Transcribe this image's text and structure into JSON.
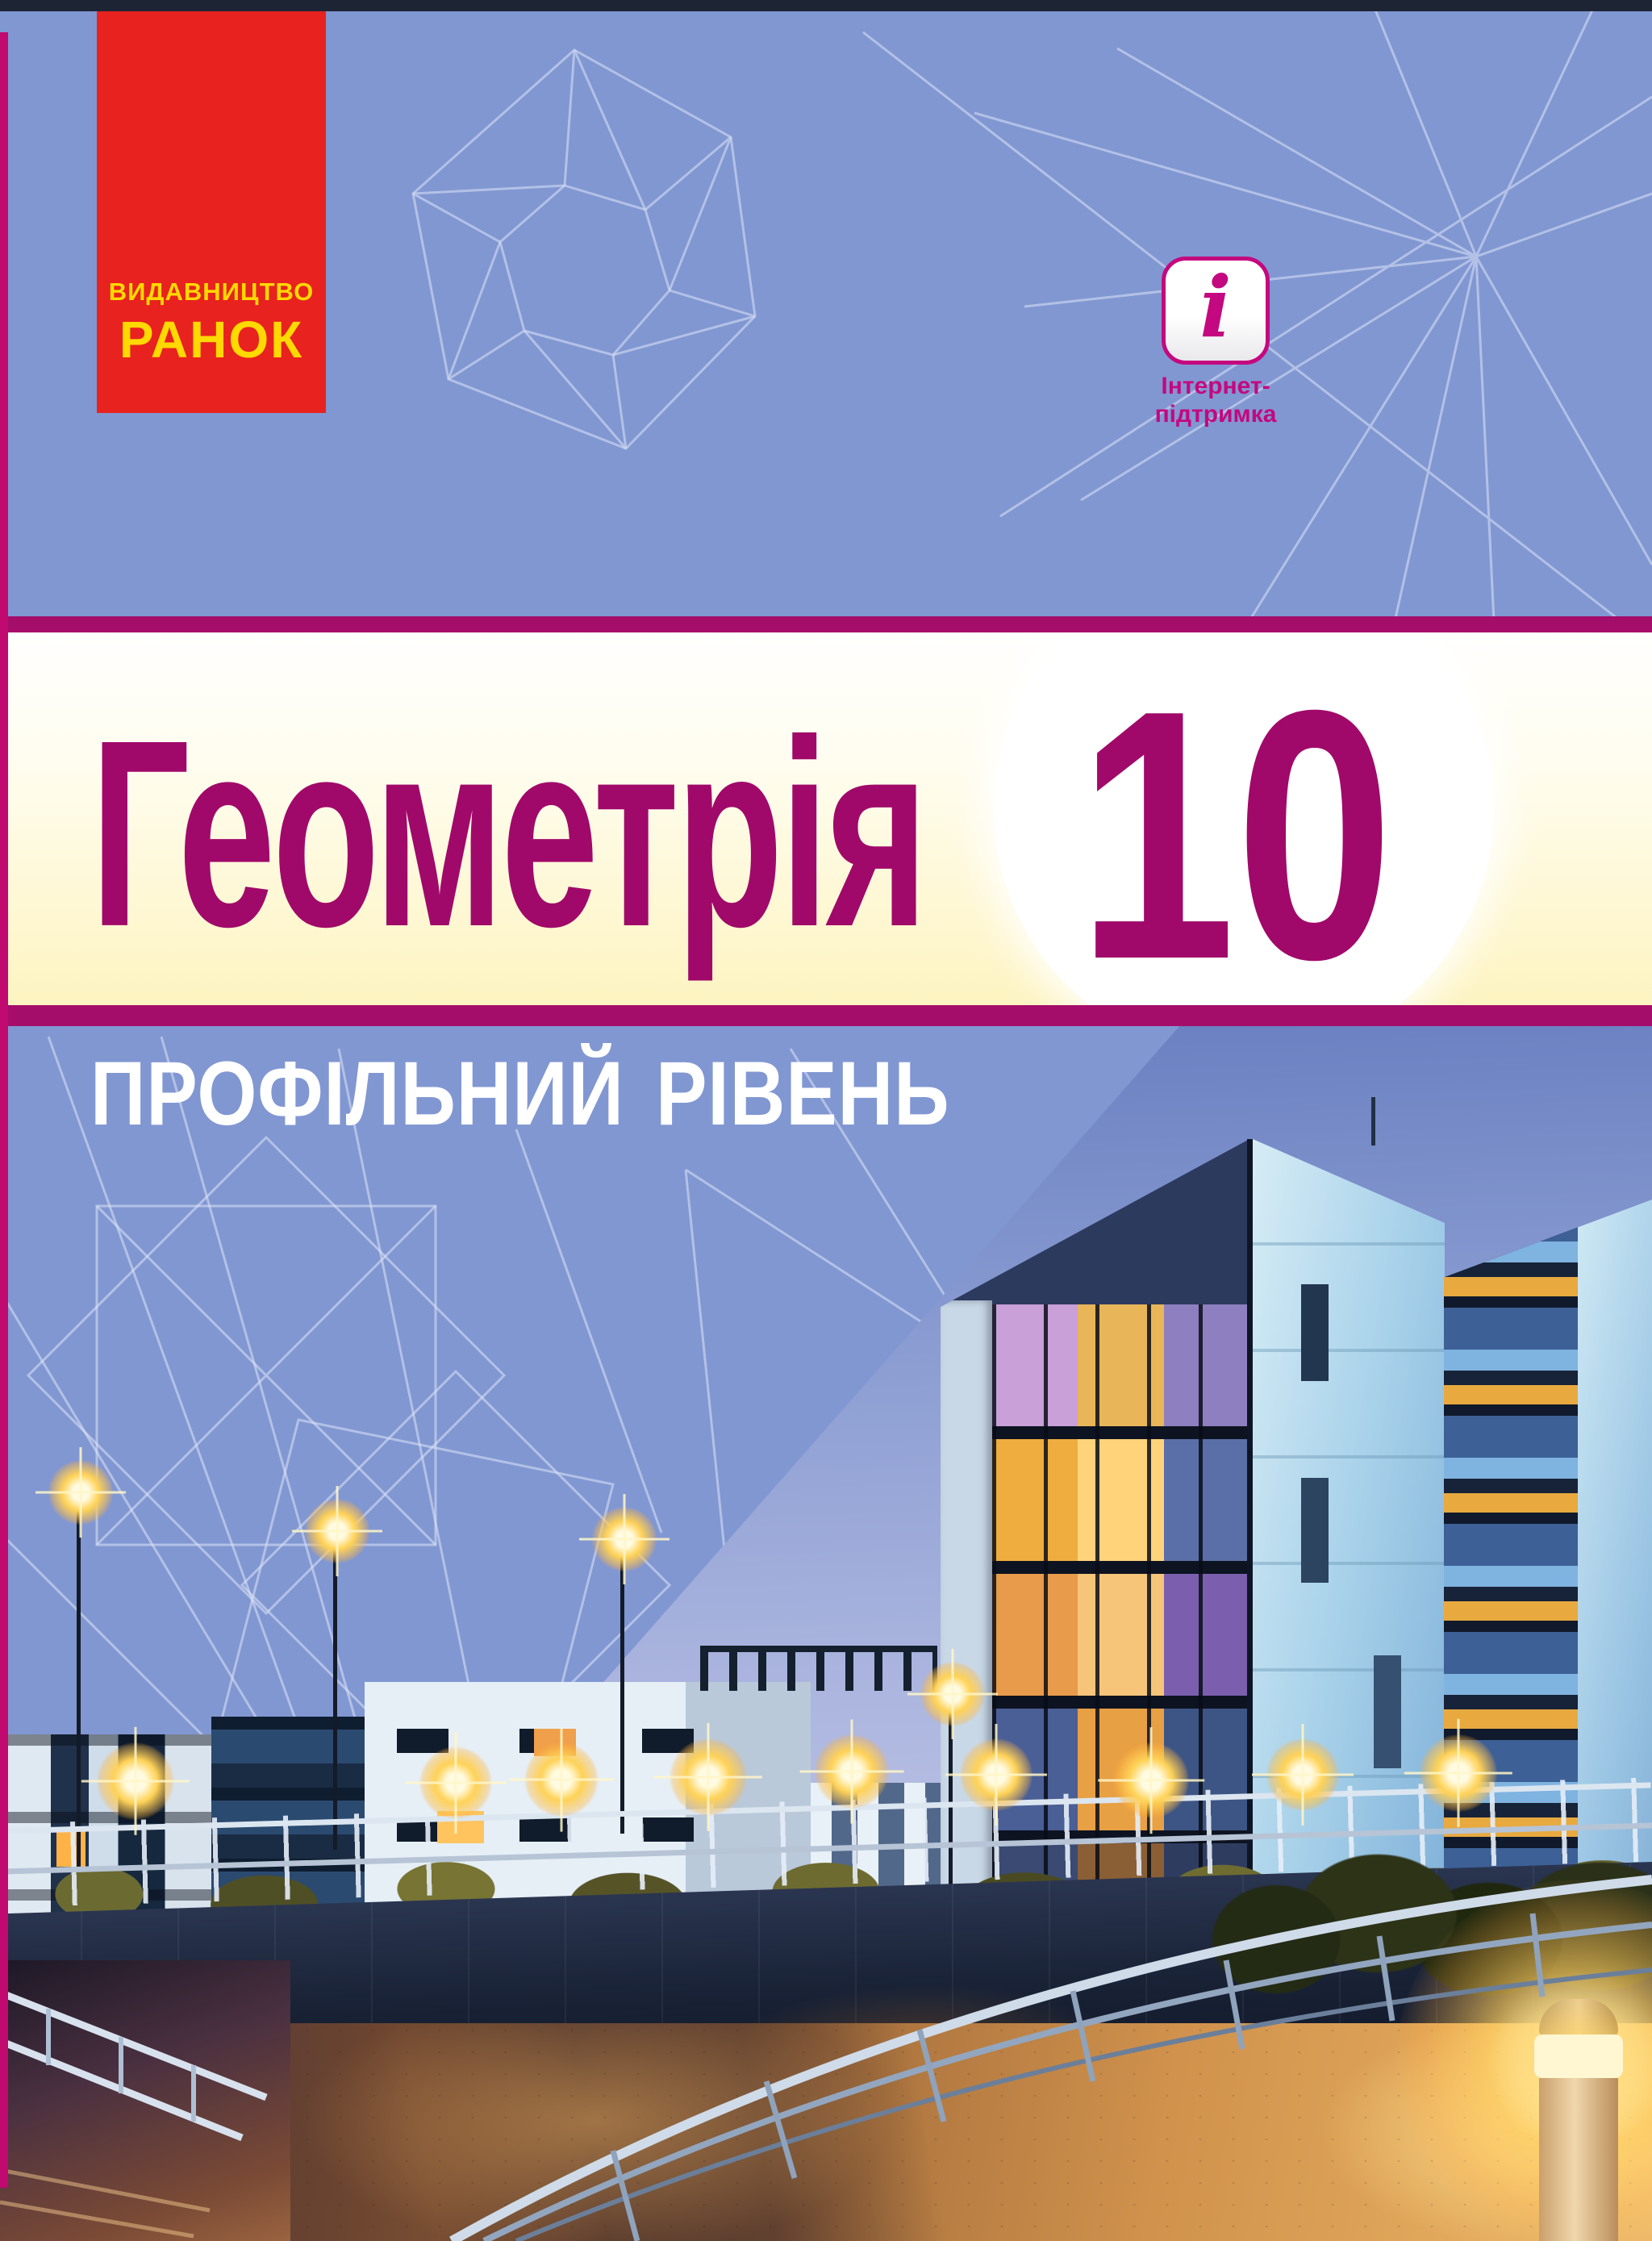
{
  "publisher": {
    "line1": "ВИДАВНИЦТВО",
    "line2": "РАНОК"
  },
  "badge": {
    "icon_glyph": "i",
    "label_line1": "Інтернет-",
    "label_line2": "підтримка"
  },
  "title": {
    "subject": "Геометрія",
    "grade": "10"
  },
  "level_label": "ПРОФІЛЬНИЙ РІВЕНЬ",
  "colors": {
    "bg_periwinkle": "#8197d2",
    "top_bar_navy": "#1d2534",
    "edge_stripe_magenta": "#c00a70",
    "banner_red": "#e8221e",
    "banner_yellow": "#ffd900",
    "badge_magenta": "#c4087f",
    "band_stripe_magenta": "#a50d6b",
    "title_magenta": "#a0096a",
    "band_cream": "#fdf3bd",
    "level_white": "#ffffff",
    "sky_top": "#6a80c1",
    "sky_bottom": "#bcc3e4",
    "wireframe_line": "#dce4f5"
  }
}
